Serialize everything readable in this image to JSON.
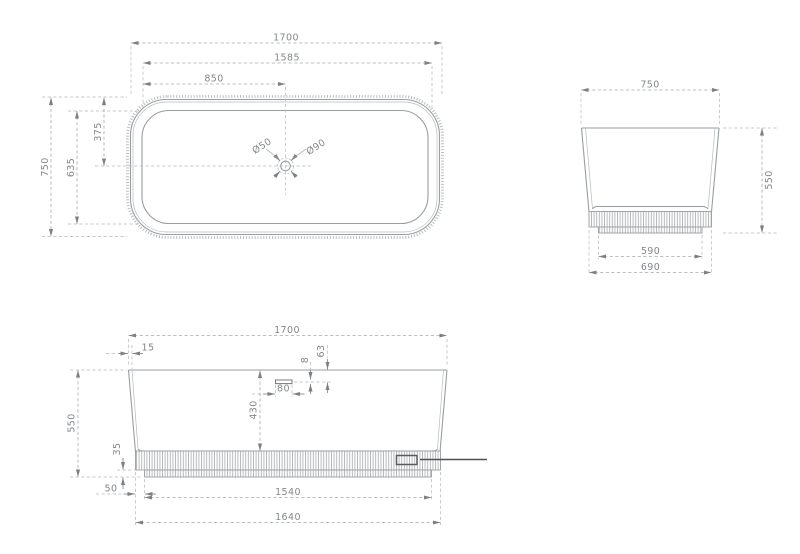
{
  "colors": {
    "background": "#ffffff",
    "geometry_line": "#989ea1",
    "dimension_line": "#a6aaad",
    "text": "#84888b",
    "accent_dark": "#4e5255"
  },
  "views": {
    "top": {
      "dims": {
        "overall_width": "1700",
        "rim_width": "1585",
        "half_width": "850",
        "overall_depth": "750",
        "rim_depth": "635",
        "half_depth": "375",
        "drain_small": "Ø50",
        "drain_large": "Ø90"
      }
    },
    "side": {
      "dims": {
        "overall_width": "750",
        "height": "550",
        "plinth_width": "590",
        "base_width": "690"
      }
    },
    "front": {
      "dims": {
        "overall_width": "1700",
        "rim_thickness": "15",
        "overflow_offset": "63",
        "overflow_slot_height": "8",
        "overflow_slot_width": "80",
        "inner_depth": "430",
        "height": "550",
        "plinth_height": "35",
        "base_inset": "50",
        "plinth_width": "1540",
        "base_width": "1640"
      }
    }
  }
}
